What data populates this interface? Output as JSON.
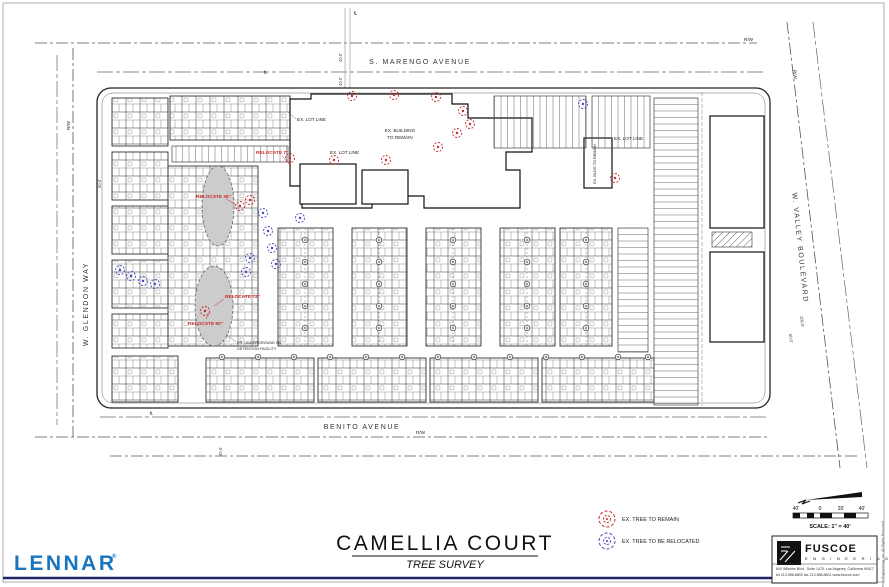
{
  "colors": {
    "builder_blue": "#1b75bc",
    "tree_remain": "#cc2a2a",
    "tree_relocate": "#4646c8",
    "rule_navy": "#1c2766"
  },
  "title_block": {
    "project": "CAMELLIA COURT",
    "subtitle": "TREE SURVEY"
  },
  "branding": {
    "builder": "LENNAR",
    "builder_reg": "®",
    "engineer_name": "FUSCOE",
    "engineer_sub": "E N G I N E E R I N G",
    "engineer_address1": "600 Wilshire Blvd., Suite 1470, Los Angeles, California 90017",
    "engineer_address2": "tel 213.988.8800   fax 213.988.8801   www.fuscoe.com",
    "copyright_note": "© Fuscoe Engineering, Inc. All Rights Reserved"
  },
  "streets": {
    "north": "S. MARENGO AVENUE",
    "south": "BENITO AVENUE",
    "west": "W. GLENDON WAY",
    "east": "W. VALLEY BOULEVARD"
  },
  "legend": {
    "items": [
      {
        "label": "EX. TREE TO REMAIN"
      },
      {
        "label": "EX. TREE TO BE RELOCATED"
      }
    ]
  },
  "scale_bar": {
    "ticks": [
      "40'",
      "0",
      "20'",
      "40'"
    ],
    "label": "SCALE: 1\" = 40'"
  },
  "plan": {
    "labels": {
      "rw": "R/W",
      "centerline": "℄",
      "ex_lot_line": "EX. LOT LINE",
      "ex_building_1": "EX. BUILDING",
      "ex_building_2": "TO REMAIN",
      "ex_bldg": "EX. BLDG TO REMAIN",
      "detention_1": "PR. UNDERGROUND SD",
      "detention_2": "DETENTION FACILITY",
      "dim_40": "40.0'",
      "dim_60": "60.0'",
      "dim_100": "100.0'"
    },
    "red_notes": [
      {
        "text": "RELOCATE 7\""
      },
      {
        "text": "RELOCATE 36\""
      },
      {
        "text": "RELOCATE 72\""
      },
      {
        "text": "RELOCATE 60\""
      }
    ],
    "trees": {
      "remain": [
        [
          352,
          96
        ],
        [
          394,
          95
        ],
        [
          436,
          97
        ],
        [
          463,
          111
        ],
        [
          457,
          133
        ],
        [
          438,
          147
        ],
        [
          470,
          124
        ],
        [
          290,
          158
        ],
        [
          334,
          160
        ],
        [
          386,
          160
        ],
        [
          240,
          206
        ],
        [
          250,
          200
        ],
        [
          205,
          311
        ],
        [
          615,
          178
        ]
      ],
      "relocate": [
        [
          120,
          270
        ],
        [
          131,
          276
        ],
        [
          143,
          281
        ],
        [
          155,
          284
        ],
        [
          263,
          213
        ],
        [
          268,
          231
        ],
        [
          272,
          248
        ],
        [
          276,
          264
        ],
        [
          583,
          104
        ],
        [
          300,
          218
        ],
        [
          250,
          258
        ],
        [
          246,
          272
        ]
      ],
      "proposed": [
        [
          305,
          240
        ],
        [
          305,
          262
        ],
        [
          305,
          284
        ],
        [
          305,
          306
        ],
        [
          305,
          328
        ],
        [
          379,
          240
        ],
        [
          379,
          262
        ],
        [
          379,
          284
        ],
        [
          379,
          306
        ],
        [
          379,
          328
        ],
        [
          453,
          240
        ],
        [
          453,
          262
        ],
        [
          453,
          284
        ],
        [
          453,
          306
        ],
        [
          453,
          328
        ],
        [
          527,
          240
        ],
        [
          527,
          262
        ],
        [
          527,
          284
        ],
        [
          527,
          306
        ],
        [
          527,
          328
        ],
        [
          586,
          240
        ],
        [
          586,
          262
        ],
        [
          586,
          284
        ],
        [
          586,
          306
        ],
        [
          586,
          328
        ],
        [
          222,
          357
        ],
        [
          258,
          357
        ],
        [
          294,
          357
        ],
        [
          330,
          357
        ],
        [
          366,
          357
        ],
        [
          402,
          357
        ],
        [
          438,
          357
        ],
        [
          474,
          357
        ],
        [
          510,
          357
        ],
        [
          546,
          357
        ],
        [
          582,
          357
        ],
        [
          618,
          357
        ],
        [
          648,
          357
        ]
      ]
    }
  }
}
